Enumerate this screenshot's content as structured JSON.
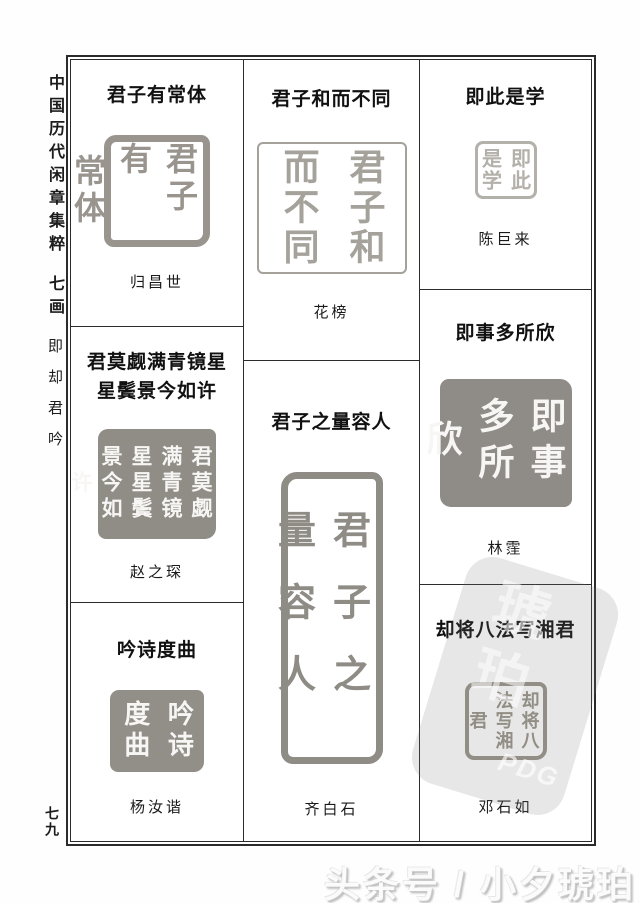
{
  "sidebar": {
    "book_title": "中国历代闲章集粹",
    "section": "七画",
    "index_chars": "即却君吟",
    "page_number": "七九"
  },
  "grid": {
    "col1": {
      "cell1": {
        "title": "君子有常体",
        "artist": "归昌世",
        "seal": {
          "style": "yang-relief",
          "chars": [
            "君子有",
            "常体"
          ]
        }
      },
      "cell2": {
        "title_line1": "君莫觑满青镜星",
        "title_line2": "星鬓景今如许",
        "artist": "赵之琛",
        "seal": {
          "style": "yin-intaglio",
          "chars": [
            "君莫觑",
            "满青镜",
            "星星鬓",
            "景今如",
            "许"
          ]
        }
      },
      "cell3": {
        "title": "吟诗度曲",
        "artist": "杨汝谐",
        "seal": {
          "style": "yin-intaglio",
          "chars": [
            "吟诗",
            "度曲"
          ]
        }
      }
    },
    "col2": {
      "cell1": {
        "title": "君子和而不同",
        "artist": "花榜",
        "seal": {
          "style": "yang-relief-thin",
          "chars": [
            "君子和",
            "而不同"
          ]
        }
      },
      "cell2": {
        "title": "君子之量容人",
        "artist": "齐白石",
        "seal": {
          "style": "yang-relief-tall",
          "chars": [
            "君子之",
            "量容人"
          ]
        }
      }
    },
    "col3": {
      "cell1": {
        "title": "即此是学",
        "artist": "陈巨来",
        "seal": {
          "style": "yang-relief-small",
          "chars": [
            "即此",
            "是学"
          ]
        }
      },
      "cell2": {
        "title": "即事多所欣",
        "artist": "林霔",
        "seal": {
          "style": "yin-intaglio",
          "chars": [
            "即事",
            "多所",
            "欣"
          ]
        }
      },
      "cell3": {
        "title": "却将八法写湘君",
        "artist": "邓石如",
        "seal": {
          "style": "yang-relief",
          "chars": [
            "却将八",
            "法写湘",
            "君"
          ]
        }
      }
    }
  },
  "watermark": {
    "bottom_text": "头条号 / 小夕琥珀",
    "stamp_chars": "琥珀",
    "stamp_letters": "PDG"
  },
  "colors": {
    "seal_gray": "#99948e",
    "seal_block_gray": "#908c86",
    "frame": "#2b2b2b",
    "title_text": "#111111"
  }
}
